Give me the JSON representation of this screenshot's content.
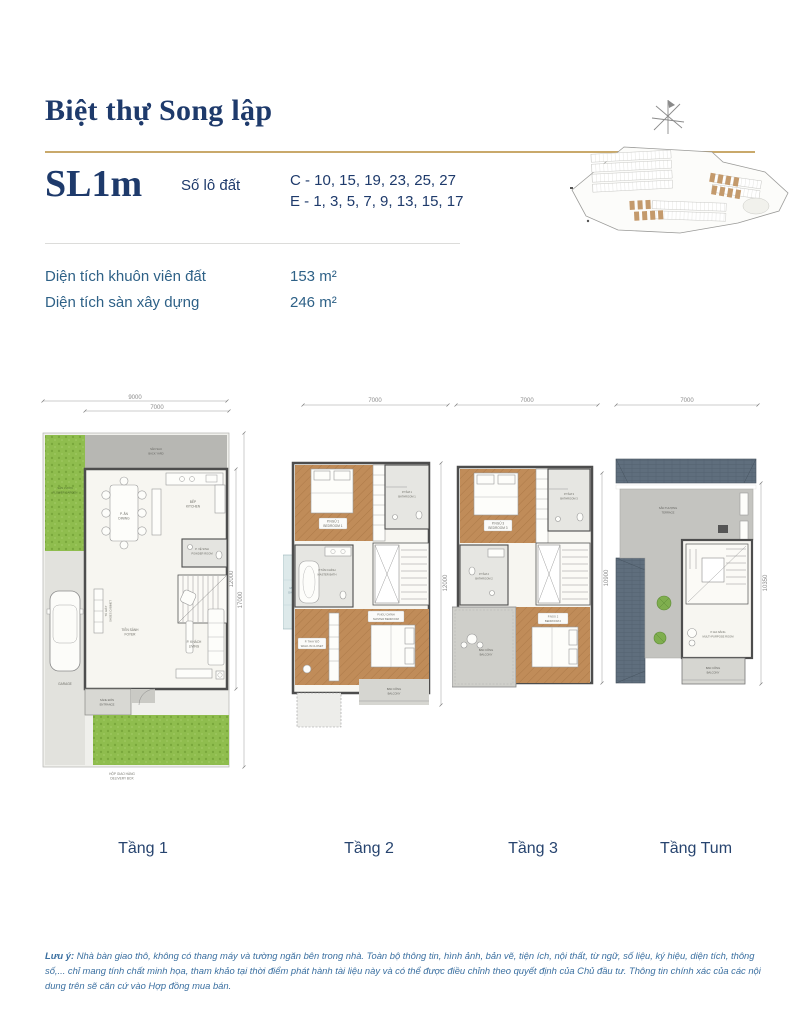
{
  "header": {
    "title": "Biệt thự Song lập",
    "model": "SL1m",
    "lot_label": "Số lô đất",
    "lot_lines": [
      "C - 10, 15, 19, 23, 25, 27",
      "E - 1, 3, 5, 7, 9, 13, 15, 17"
    ]
  },
  "info": {
    "rows": [
      {
        "label": "Diện tích khuôn viên đất",
        "value": "153 m²"
      },
      {
        "label": "Diện tích sàn xây dựng",
        "value": "246 m²"
      }
    ]
  },
  "plans": [
    {
      "caption": "Tầng 1",
      "dims": {
        "top_outer": "9000",
        "top_inner": "7000",
        "right_inner": "12000",
        "right_outer": "17000"
      },
      "rooms": {
        "back_yard": [
          "SÂN SAU",
          "BACK YARD"
        ],
        "garden": [
          "SÂN VƯỜN",
          "FLOWER GARDEN"
        ],
        "dining": [
          "P. ĂN",
          "DINING"
        ],
        "kitchen": [
          "BẾP",
          "KITCHEN"
        ],
        "powder": [
          "P. VỆ SINH",
          "POWDER ROOM"
        ],
        "shoes": [
          "TỦ GIÀY",
          "SHOES CABINET"
        ],
        "foyer": [
          "TIỀN SẢNH",
          "FOYER"
        ],
        "living": [
          "P. KHÁCH",
          "LIVING"
        ],
        "garage": [
          "GARAGE"
        ],
        "entrance": [
          "SẢNH ĐÓN",
          "ENTRANCE"
        ],
        "delivery": [
          "HỘP GIAO HÀNG",
          "DELIVERY BOX"
        ]
      }
    },
    {
      "caption": "Tầng 2",
      "dims": {
        "top": "7000",
        "right": "12000"
      },
      "rooms": {
        "bedroom1": [
          "P.NGỦ 1",
          "BEDROOM 1"
        ],
        "bathroom1": [
          "P.TẮM 1",
          "BATHROOM 1"
        ],
        "master_bath": [
          "P.TẮM CHÍNH",
          "MASTER BATH"
        ],
        "garage_roof": [
          "MÁI GARAGE",
          "GARAGE ROOF"
        ],
        "closet": [
          "P. THAY ĐỒ",
          "WALK-IN CLOSET"
        ],
        "master_bedroom": [
          "P.NGỦ CHÍNH",
          "MASTER BEDROOM"
        ],
        "balcony": [
          "BAN CÔNG",
          "BALCONY"
        ]
      }
    },
    {
      "caption": "Tầng 3",
      "dims": {
        "top": "7000",
        "right": "10900"
      },
      "rooms": {
        "bedroom3": [
          "P.NGỦ 3",
          "BEDROOM 3"
        ],
        "bathroom3": [
          "P.TẮM 3",
          "BATHROOM 3"
        ],
        "bathroom2": [
          "P.TẮM 2",
          "BATHROOM 2"
        ],
        "bedroom2": [
          "P.NGỦ 2",
          "BEDROOM 2"
        ],
        "balcony": [
          "BAN CÔNG",
          "BALCONY"
        ]
      }
    },
    {
      "caption": "Tầng Tum",
      "dims": {
        "top": "7000",
        "right": "10350"
      },
      "rooms": {
        "terrace": [
          "SÂN THƯỢNG",
          "TERRACE"
        ],
        "multi_purpose": [
          "P. ĐA NĂNG",
          "MULTI-PURPOSE ROOM"
        ],
        "balcony": [
          "BAN CÔNG",
          "BALCONY"
        ]
      }
    }
  ],
  "note": {
    "prefix": "Lưu ý:",
    "body": " Nhà bàn giao thô, không có thang máy và tường ngăn bên trong nhà. Toàn bộ thông tin, hình ảnh, bản vẽ, tiện ích, nội thất, từ ngữ, số liệu, ký hiệu, diện tích, thông số,... chỉ mang tính chất minh họa, tham khảo tại thời điểm phát hành tài liệu này và có thể được điều chỉnh theo quyết định của Chủ đầu tư. Thông tin chính xác của các nội dung trên sẽ căn cứ vào Hợp đồng mua bán."
  },
  "colors": {
    "navy": "#1e3a6b",
    "gold": "#c9a96b",
    "label_blue": "#2e6187",
    "note_blue": "#3a6fa0",
    "grass_green": "#8fbd4e",
    "wood_brown": "#bd8a5a",
    "roof_slate": "#5f6e7d",
    "lot_highlight": "#c49a6c"
  },
  "icons": {
    "compass": "compass-rose"
  }
}
